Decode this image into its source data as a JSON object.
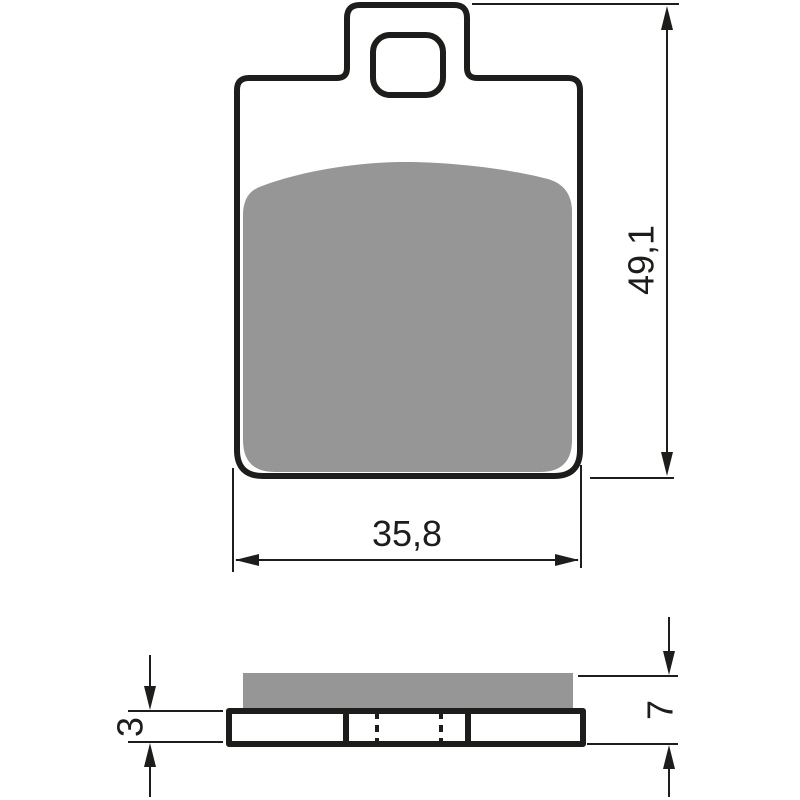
{
  "diagram": {
    "type": "technical-drawing",
    "subject": "brake-pad-two-view-drawing",
    "colors": {
      "outline": "#1d1d1b",
      "friction_material": "#969696",
      "background": "#ffffff"
    },
    "views": {
      "front": {
        "name": "front-view",
        "features": [
          "backplate-outline",
          "top-tab",
          "tab-hole",
          "friction-material-pad"
        ]
      },
      "side": {
        "name": "side-view",
        "features": [
          "friction-material-layer",
          "backing-plate",
          "segment-dividers",
          "hidden-hole-lines"
        ]
      }
    },
    "dimensions": {
      "front_height": {
        "label": "49,1",
        "orientation": "vertical"
      },
      "front_width": {
        "label": "35,8",
        "orientation": "horizontal"
      },
      "plate_thickness": {
        "label": "3",
        "orientation": "vertical"
      },
      "total_thickness": {
        "label": "7",
        "orientation": "vertical"
      }
    }
  }
}
